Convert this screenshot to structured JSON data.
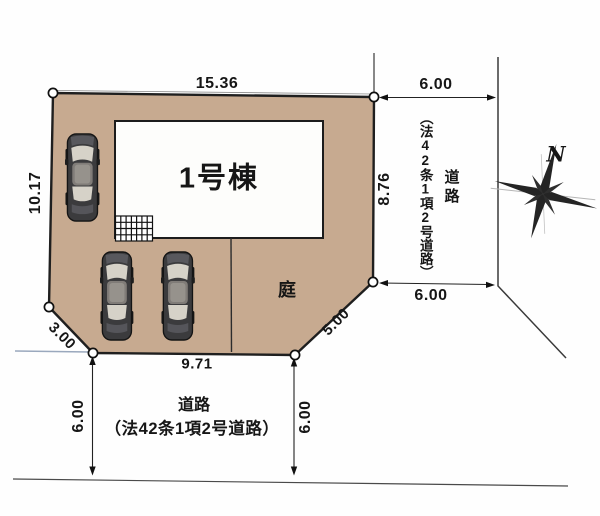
{
  "site_plan": {
    "building": {
      "label": "1号棟"
    },
    "garden": {
      "label": "庭"
    },
    "edges": {
      "top": "15.36",
      "left": "10.17",
      "right": "8.76",
      "bottom": "9.71",
      "chamfer_left": "3.00",
      "chamfer_right": "5.00"
    }
  },
  "right_road": {
    "name_vertical": "道路",
    "law_vertical": "（法42条1項2号道路）",
    "width_top": "6.00",
    "width_bottom": "6.00"
  },
  "bottom_road": {
    "name": "道路",
    "law": "（法42条1項2号道路）",
    "width_left": "6.00",
    "width_right": "6.00"
  },
  "compass": {
    "north": "N"
  },
  "colors": {
    "plot_fill": "#c7aa90",
    "outline": "#1f1f1f",
    "car_body": "#3b3b3d",
    "car_glass": "#d6d2c8",
    "road_line": "#3a3a3a",
    "water_line": "#9aa8bd"
  }
}
